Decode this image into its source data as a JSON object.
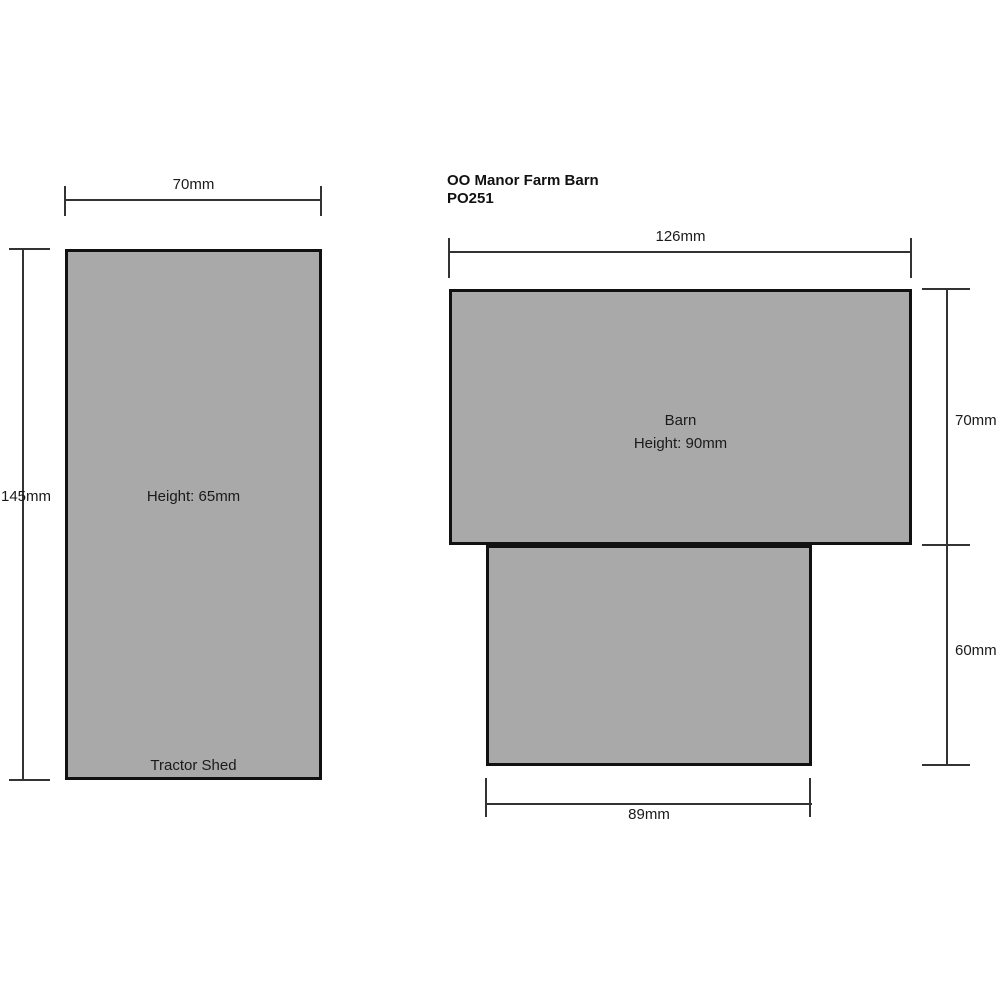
{
  "title": {
    "product": "OO Manor Farm Barn",
    "code": "PO251"
  },
  "tractor_shed": {
    "label": "Tractor Shed",
    "height_text": "Height: 65mm",
    "width_dim": "70mm",
    "length_dim": "145mm"
  },
  "barn": {
    "label": "Barn",
    "height_text": "Height: 90mm",
    "width_dim": "126mm",
    "upper_depth_dim": "70mm",
    "lower_depth_dim": "60mm",
    "lower_width_dim": "89mm"
  },
  "colors": {
    "footprint_fill": "#a9a9a9",
    "footprint_border": "#111111",
    "dimension_line": "#333333",
    "text": "#1a1a1a",
    "background": "#ffffff"
  }
}
